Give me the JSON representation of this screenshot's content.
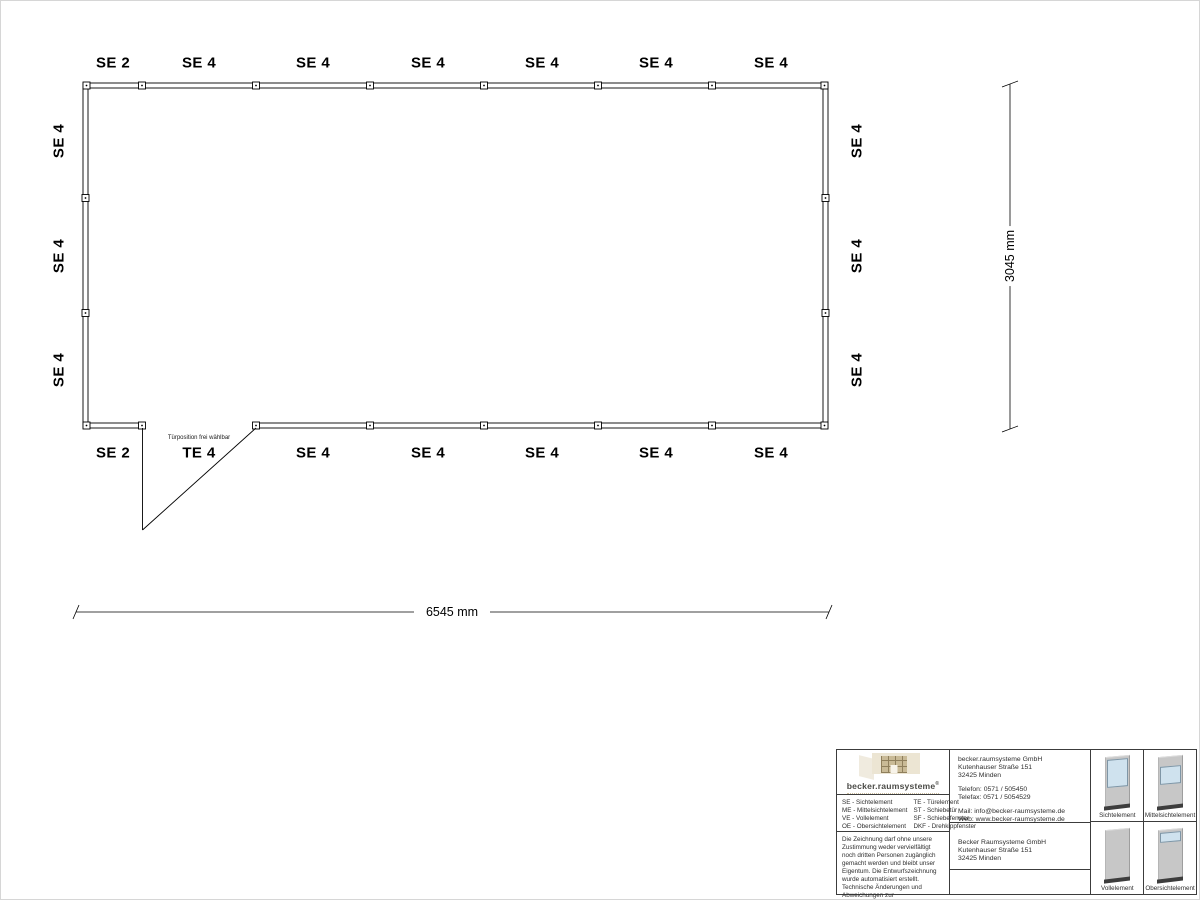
{
  "plan": {
    "top_labels": [
      "SE 2",
      "SE 4",
      "SE 4",
      "SE 4",
      "SE 4",
      "SE 4",
      "SE 4"
    ],
    "bottom_labels": [
      "SE 2",
      "TE 4",
      "SE 4",
      "SE 4",
      "SE 4",
      "SE 4",
      "SE 4"
    ],
    "left_labels": [
      "SE 4",
      "SE 4",
      "SE 4"
    ],
    "right_labels": [
      "SE 4",
      "SE 4",
      "SE 4"
    ],
    "door_note": "Türposition frei wählbar",
    "width_dim": "6545 mm",
    "height_dim": "3045 mm"
  },
  "title_block": {
    "brand": {
      "name": "becker.raumsysteme",
      "registered": "®"
    },
    "legend": {
      "col1": [
        "SE - Sichtelement",
        "ME - Mittelsichtelement",
        "VE - Vollelement",
        "OE - Obersichtelement"
      ],
      "col2": [
        "TE - Türelement",
        "ST - Schiebetür",
        "SF - Schiebefenster",
        "DKF - Drehkippfenster"
      ]
    },
    "disclaimer": "Die Zeichnung darf ohne unsere Zustimmung weder vervielfältigt noch dritten Personen zugänglich gemacht werden und bleibt unser Eigentum. Die Entwurfszeichnung wurde automatisiert erstellt. Technische Änderungen und Abweichungen zur Ausführungszeichnung behalten wir uns vor.",
    "contact": {
      "company": "becker.raumsysteme GmbH",
      "street": "Kutenhauser Straße 151",
      "city": "32425 Minden",
      "phone": "Telefon: 0571 / 505450",
      "fax": "Telefax: 0571 / 5054529",
      "mail": "Mail: info@becker-raumsysteme.de",
      "web": "Web: www.becker-raumsysteme.de"
    },
    "address": {
      "company": "Becker Raumsysteme GmbH",
      "street": "Kutenhauser Straße 151",
      "city": "32425 Minden"
    },
    "elements": [
      {
        "label": "Sichtelement"
      },
      {
        "label": "Mittelsichtelement"
      },
      {
        "label": "Vollelement"
      },
      {
        "label": "Obersichtelement"
      }
    ]
  },
  "colors": {
    "line": "#000000",
    "glass": "#cfe2ee",
    "panel_gray": "#c7c7c7",
    "panel_base": "#3d3d3d",
    "brand_text": "#4a4a46"
  }
}
